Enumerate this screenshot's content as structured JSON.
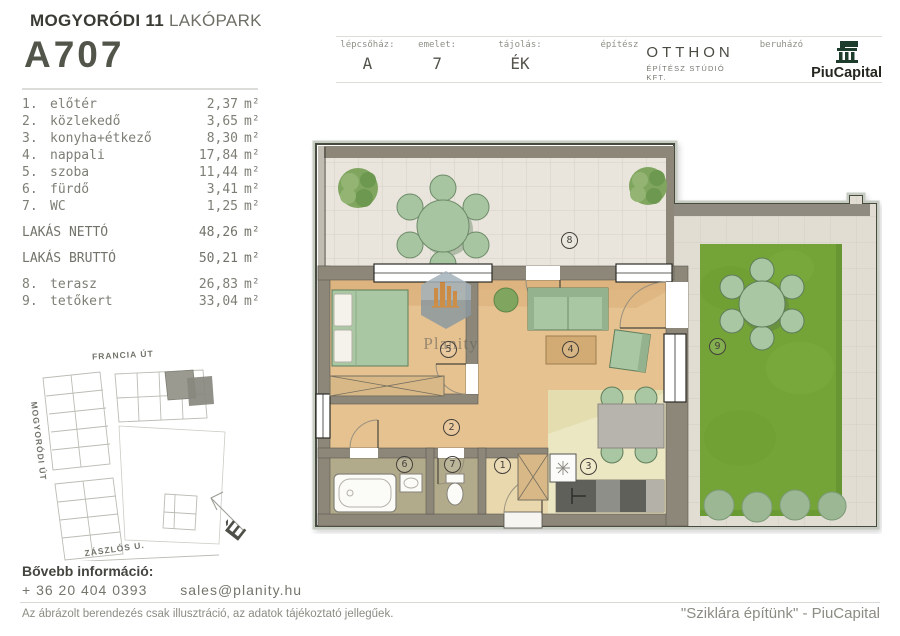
{
  "header": {
    "project_title_bold": "MOGYORÓDI 11",
    "project_title_light": "LAKÓPARK",
    "unit_id": "A707",
    "fields": [
      {
        "label": "lépcsőház:",
        "value": "A"
      },
      {
        "label": "emelet:",
        "value": "7"
      },
      {
        "label": "tájolás:",
        "value": "ÉK"
      }
    ],
    "architect_label": "építész",
    "architect_name": "OTTHON",
    "architect_sub": "ÉPÍTÉSZ STÚDIÓ KFT.",
    "developer_label": "beruházó",
    "developer_name": "PiuCapital"
  },
  "rooms": {
    "unit": "m²",
    "items": [
      {
        "num": "1.",
        "name": "előtér",
        "area": "2,37"
      },
      {
        "num": "2.",
        "name": "közlekedő",
        "area": "3,65"
      },
      {
        "num": "3.",
        "name": "konyha+étkező",
        "area": "8,30"
      },
      {
        "num": "4.",
        "name": "nappali",
        "area": "17,84"
      },
      {
        "num": "5.",
        "name": "szoba",
        "area": "11,44"
      },
      {
        "num": "6.",
        "name": "fürdő",
        "area": "3,41"
      },
      {
        "num": "7.",
        "name": "WC",
        "area": "1,25"
      }
    ],
    "totals": [
      {
        "name": "LAKÁS NETTÓ",
        "area": "48,26"
      },
      {
        "name": "LAKÁS BRUTTÓ",
        "area": "50,21"
      }
    ],
    "outdoor": [
      {
        "num": "8.",
        "name": "terasz",
        "area": "26,83"
      },
      {
        "num": "9.",
        "name": "tetőkert",
        "area": "33,04"
      }
    ]
  },
  "plan": {
    "badges": [
      "1",
      "2",
      "3",
      "4",
      "5",
      "6",
      "7",
      "8",
      "9"
    ],
    "watermark": "Planity"
  },
  "sitemap": {
    "streets": [
      "FRANCIA ÚT",
      "MOGYORÓDI ÚT",
      "ZÁSZLÓS U."
    ],
    "compass": "É"
  },
  "footer": {
    "info_title": "Bővebb információ:",
    "phone": "+ 36 20 404 0393",
    "email": "sales@planity.hu",
    "disclaimer": "Az ábrázolt berendezés csak illusztráció, az adatok tájékoztató jellegűek.",
    "slogan": "\"Sziklára építünk\" - PiuCapital"
  },
  "colors": {
    "wall": "#8d8779",
    "wood_floor": "#e6c290",
    "kitchen_floor": "#ece7c3",
    "grass": "#74a437",
    "furniture_green": "#a9c7a3",
    "logo_green": "#1e3c2c"
  }
}
